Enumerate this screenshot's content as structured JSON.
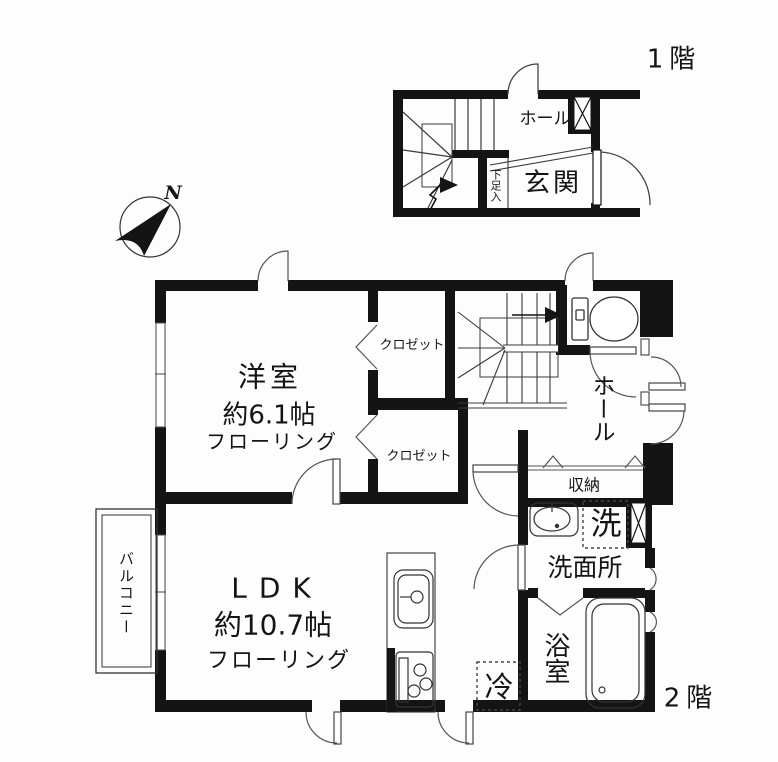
{
  "compass": {
    "north": "N"
  },
  "floor1": {
    "label": "1階",
    "rooms": {
      "hall": "ホール",
      "entrance": "玄関",
      "shoe_cabinet": "下足入"
    }
  },
  "floor2": {
    "label": "2階",
    "rooms": {
      "bedroom": {
        "name": "洋室",
        "size": "約6.1帖",
        "flooring": "フローリング"
      },
      "closet_upper": "クロゼット",
      "closet_lower": "クロゼット",
      "hall": "ホール",
      "storage": "収納",
      "washing_machine": "洗",
      "washroom": "洗面所",
      "bathroom": "浴室",
      "ldk": {
        "name": "LDK",
        "size": "約10.7帖",
        "flooring": "フローリング"
      },
      "refrigerator": "冷",
      "balcony": "バルコニー"
    }
  },
  "colors": {
    "wall": "#141414",
    "line": "#333333",
    "background": "#fdfdfd"
  }
}
